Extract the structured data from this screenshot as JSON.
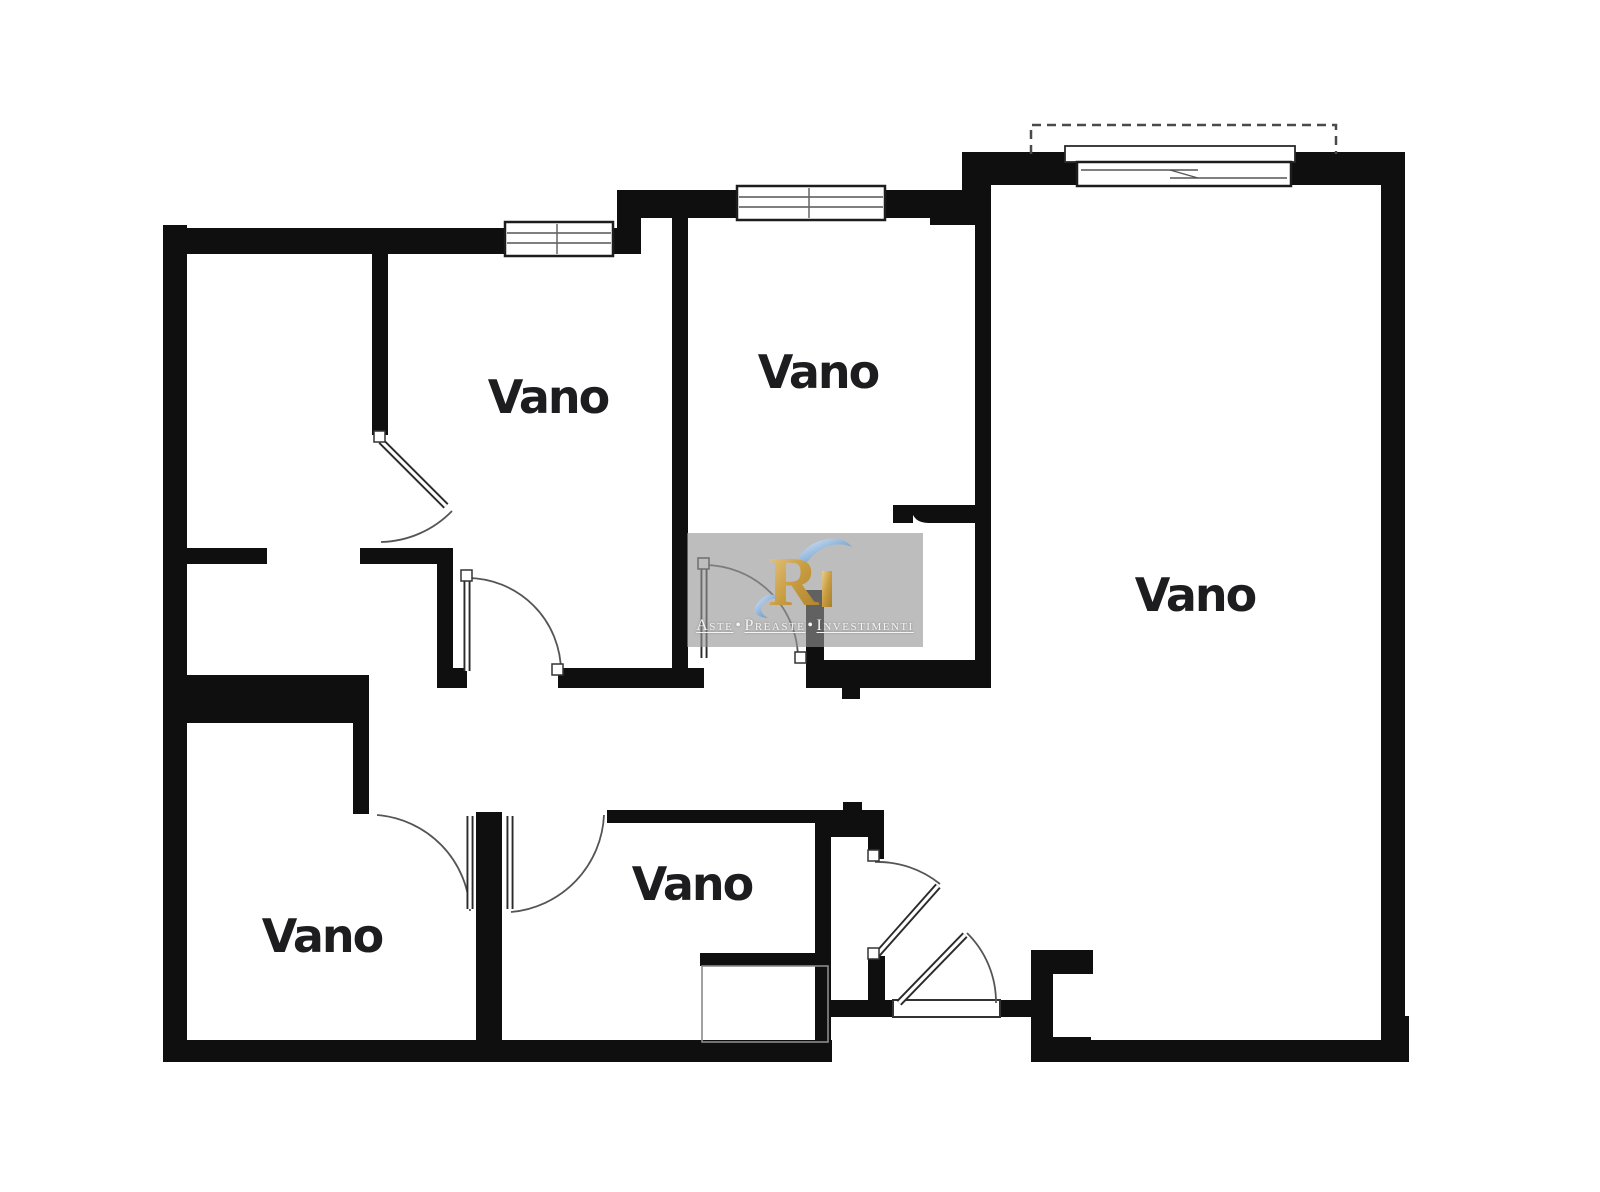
{
  "floor_plan": {
    "background_color": "#ffffff",
    "wall_color": "#0f0f0f",
    "thin_line_color": "#555555",
    "room_labels": [
      {
        "text": "Vano"
      },
      {
        "text": "Vano"
      },
      {
        "text": "Vano"
      },
      {
        "text": "Vano"
      },
      {
        "text": "Vano"
      }
    ],
    "watermark": {
      "panel_color": "rgba(148,148,148,0.62)",
      "logo_letter": "R",
      "logo_gold_color": "#c89b3f",
      "logo_blue_color": "#8fb4d9",
      "words": [
        "Aste",
        "Preaste",
        "Investimenti"
      ],
      "separator": "•",
      "text_color": "#f4f4f4"
    }
  }
}
